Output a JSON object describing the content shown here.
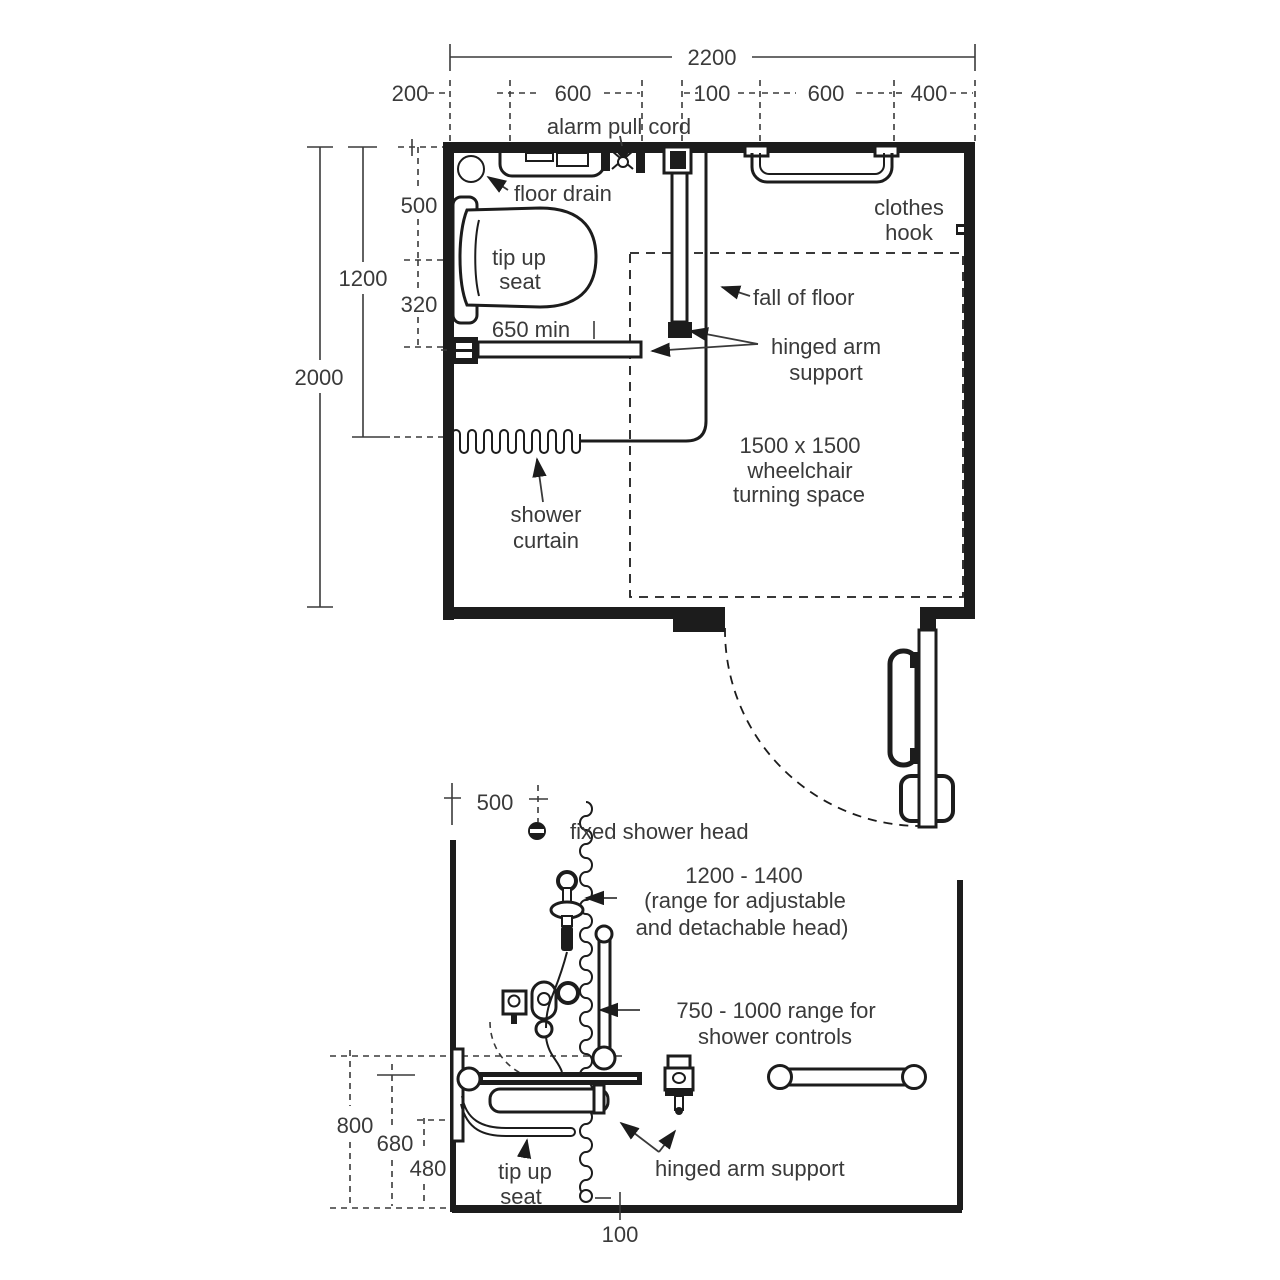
{
  "title": "accessible shower room layout diagram",
  "colors": {
    "line": "#1c1c1c",
    "text": "#3a3a3a",
    "background": "#ffffff"
  },
  "plan": {
    "dimensions": {
      "overall_width": "2200",
      "seg_200": "200",
      "seg_600a": "600",
      "seg_100": "100",
      "seg_600b": "600",
      "seg_400": "400",
      "left_500": "500",
      "left_1200": "1200",
      "left_320": "320",
      "left_2000": "2000",
      "seat_projection": "650 min"
    },
    "labels": {
      "alarm_pull_cord": "alarm pull cord",
      "floor_drain": "floor drain",
      "tip_up_seat_line1": "tip up",
      "tip_up_seat_line2": "seat",
      "clothes_hook_line1": "clothes",
      "clothes_hook_line2": "hook",
      "fall_of_floor": "fall of floor",
      "hinged_arm_line1": "hinged arm",
      "hinged_arm_line2": "support",
      "turning_line1": "1500 x 1500",
      "turning_line2": "wheelchair",
      "turning_line3": "turning space",
      "curtain_line1": "shower",
      "curtain_line2": "curtain"
    }
  },
  "elevation": {
    "dimensions": {
      "head_offset_500": "500",
      "h_800": "800",
      "h_680": "680",
      "h_480": "480",
      "gap_100": "100"
    },
    "labels": {
      "fixed_head": "fixed shower head",
      "range_line1": "1200 - 1400",
      "range_line2": "(range for adjustable",
      "range_line3": "and detachable head)",
      "controls_line1": "750 - 1000 range for",
      "controls_line2": "shower controls",
      "seat_line1": "tip up",
      "seat_line2": "seat",
      "arm_support": "hinged arm support"
    }
  }
}
